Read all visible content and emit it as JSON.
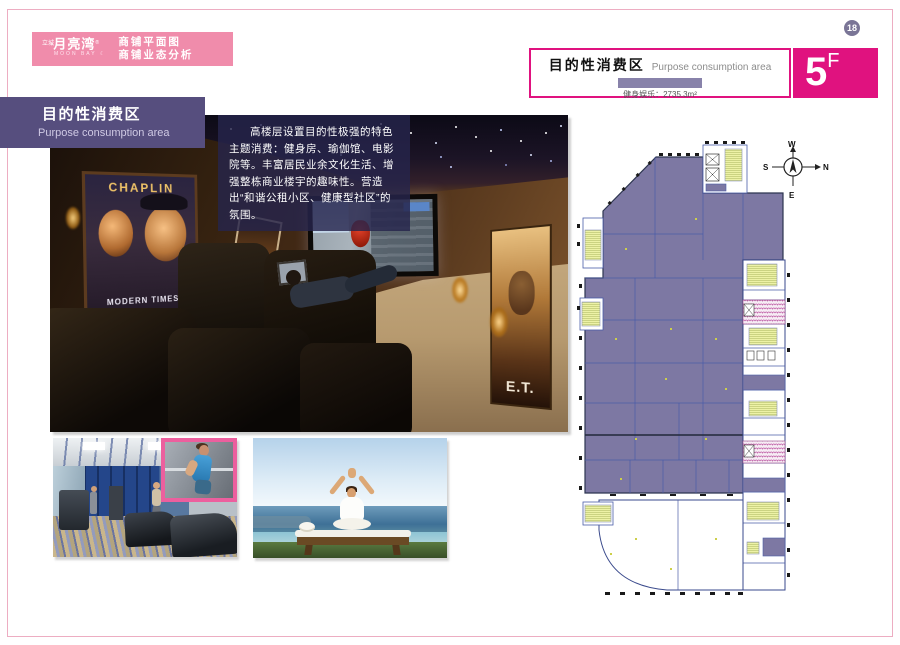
{
  "page": {
    "number": "18"
  },
  "banner": {
    "brand_prefix": "立城",
    "brand_name": "月亮湾",
    "brand_reg": "®",
    "brand_sub": "MOON BAY",
    "moon_icon": "☾",
    "line1": "商铺平面图",
    "line2": "商铺业态分析"
  },
  "header": {
    "title_cn": "目的性消费区",
    "title_en": "Purpose consumption area",
    "legend_text": "健身娱乐：2735.3m²",
    "floor_number": "5",
    "floor_suffix": "F"
  },
  "section_label": {
    "title_cn": "目的性消费区",
    "title_en": "Purpose consumption area"
  },
  "description": {
    "text": "高楼层设置目的性极强的特色主题消费：健身房、瑜伽馆、电影院等。丰富居民业余文化生活、增强整栋商业楼宇的趣味性。营造出“和谐公租小区、健康型社区”的氛围。"
  },
  "theater": {
    "posters": {
      "chaplin": "CHAPLIN",
      "modern_times": "MODERN TIMES",
      "grease": "GREASE",
      "et": "E.T."
    }
  },
  "floor_plan": {
    "compass": {
      "up": "W",
      "down": "E",
      "left": "S",
      "right": "N"
    }
  },
  "colors": {
    "accent_magenta": "#e0127f",
    "banner_pink": "#f08cab",
    "label_purple": "#564e7e",
    "plan_area_purple": "#7d78a3",
    "legend_swatch": "#8882aa",
    "page_badge": "#7a7596"
  }
}
